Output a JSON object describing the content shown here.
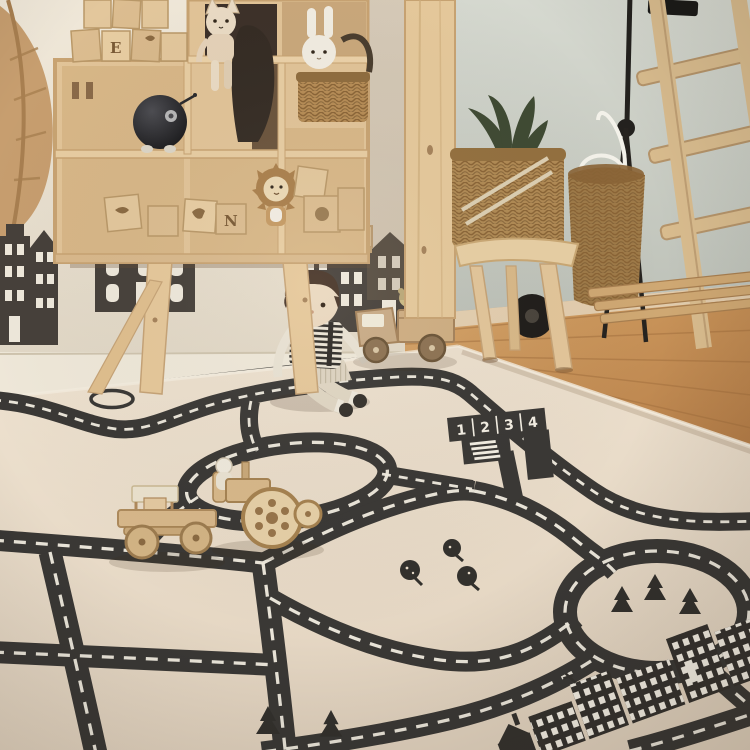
{
  "scene": {
    "type": "photograph",
    "setting": "children's playroom with a road-map play rug, wooden cubby shelf with toys, wall decals of canal houses, stool with baskets, and a wooden ladder"
  },
  "colors": {
    "wall_left": "#ebe2d2",
    "wall_right": "#c9cdc4",
    "wood_light": "#e2c498",
    "floor_wood": "#c28a54",
    "rug": "#e7dbc9",
    "road": "#3a3835",
    "road_marking": "#f3eee3",
    "decal_dark": "#46403a",
    "basket_wicker": "#ad8752",
    "pineapple_leaves": "#3f4a33",
    "pineapple_body": "#d2c23f",
    "black_toy": "#1d1d1f",
    "doll_hair": "#473427"
  },
  "rug": {
    "parking_labels": [
      "1",
      "2",
      "3",
      "4"
    ],
    "features": [
      "top edge road",
      "small ring",
      "center loop road",
      "numbered parking bays",
      "zebra crossing",
      "mid road",
      "left vertical road",
      "center vertical road",
      "bottom road",
      "sweeping curve road",
      "roundabout with pine trees",
      "city skyline print",
      "round trees",
      "pine trees"
    ]
  },
  "blocks": {
    "letters": [
      "E",
      "N"
    ]
  },
  "objects": {
    "shelf": "wooden cubby shelf",
    "bench": "wooden bench",
    "cat_plush": "cat plush sitting on shelf",
    "bunny_plush": "white bunny plush",
    "lion_plush": "lion plush",
    "black_ball_toy": "round black toy",
    "wooden_blocks": "stacked picture blocks",
    "boy_doll": "rag doll boy in striped shirt",
    "toy_truck": "wooden truck with teddies",
    "toy_tractor": "wooden tractor",
    "toy_flatbed": "wooden flatbed cart",
    "pineapple_toy": "plush pineapple",
    "stool": "wooden stool",
    "baskets": "wicker baskets",
    "ladder": "wooden ladder",
    "lamp": "black floor lamp",
    "leaf_decor": "wooden leaf wall decor",
    "house_decals": "canal house wall decals"
  }
}
